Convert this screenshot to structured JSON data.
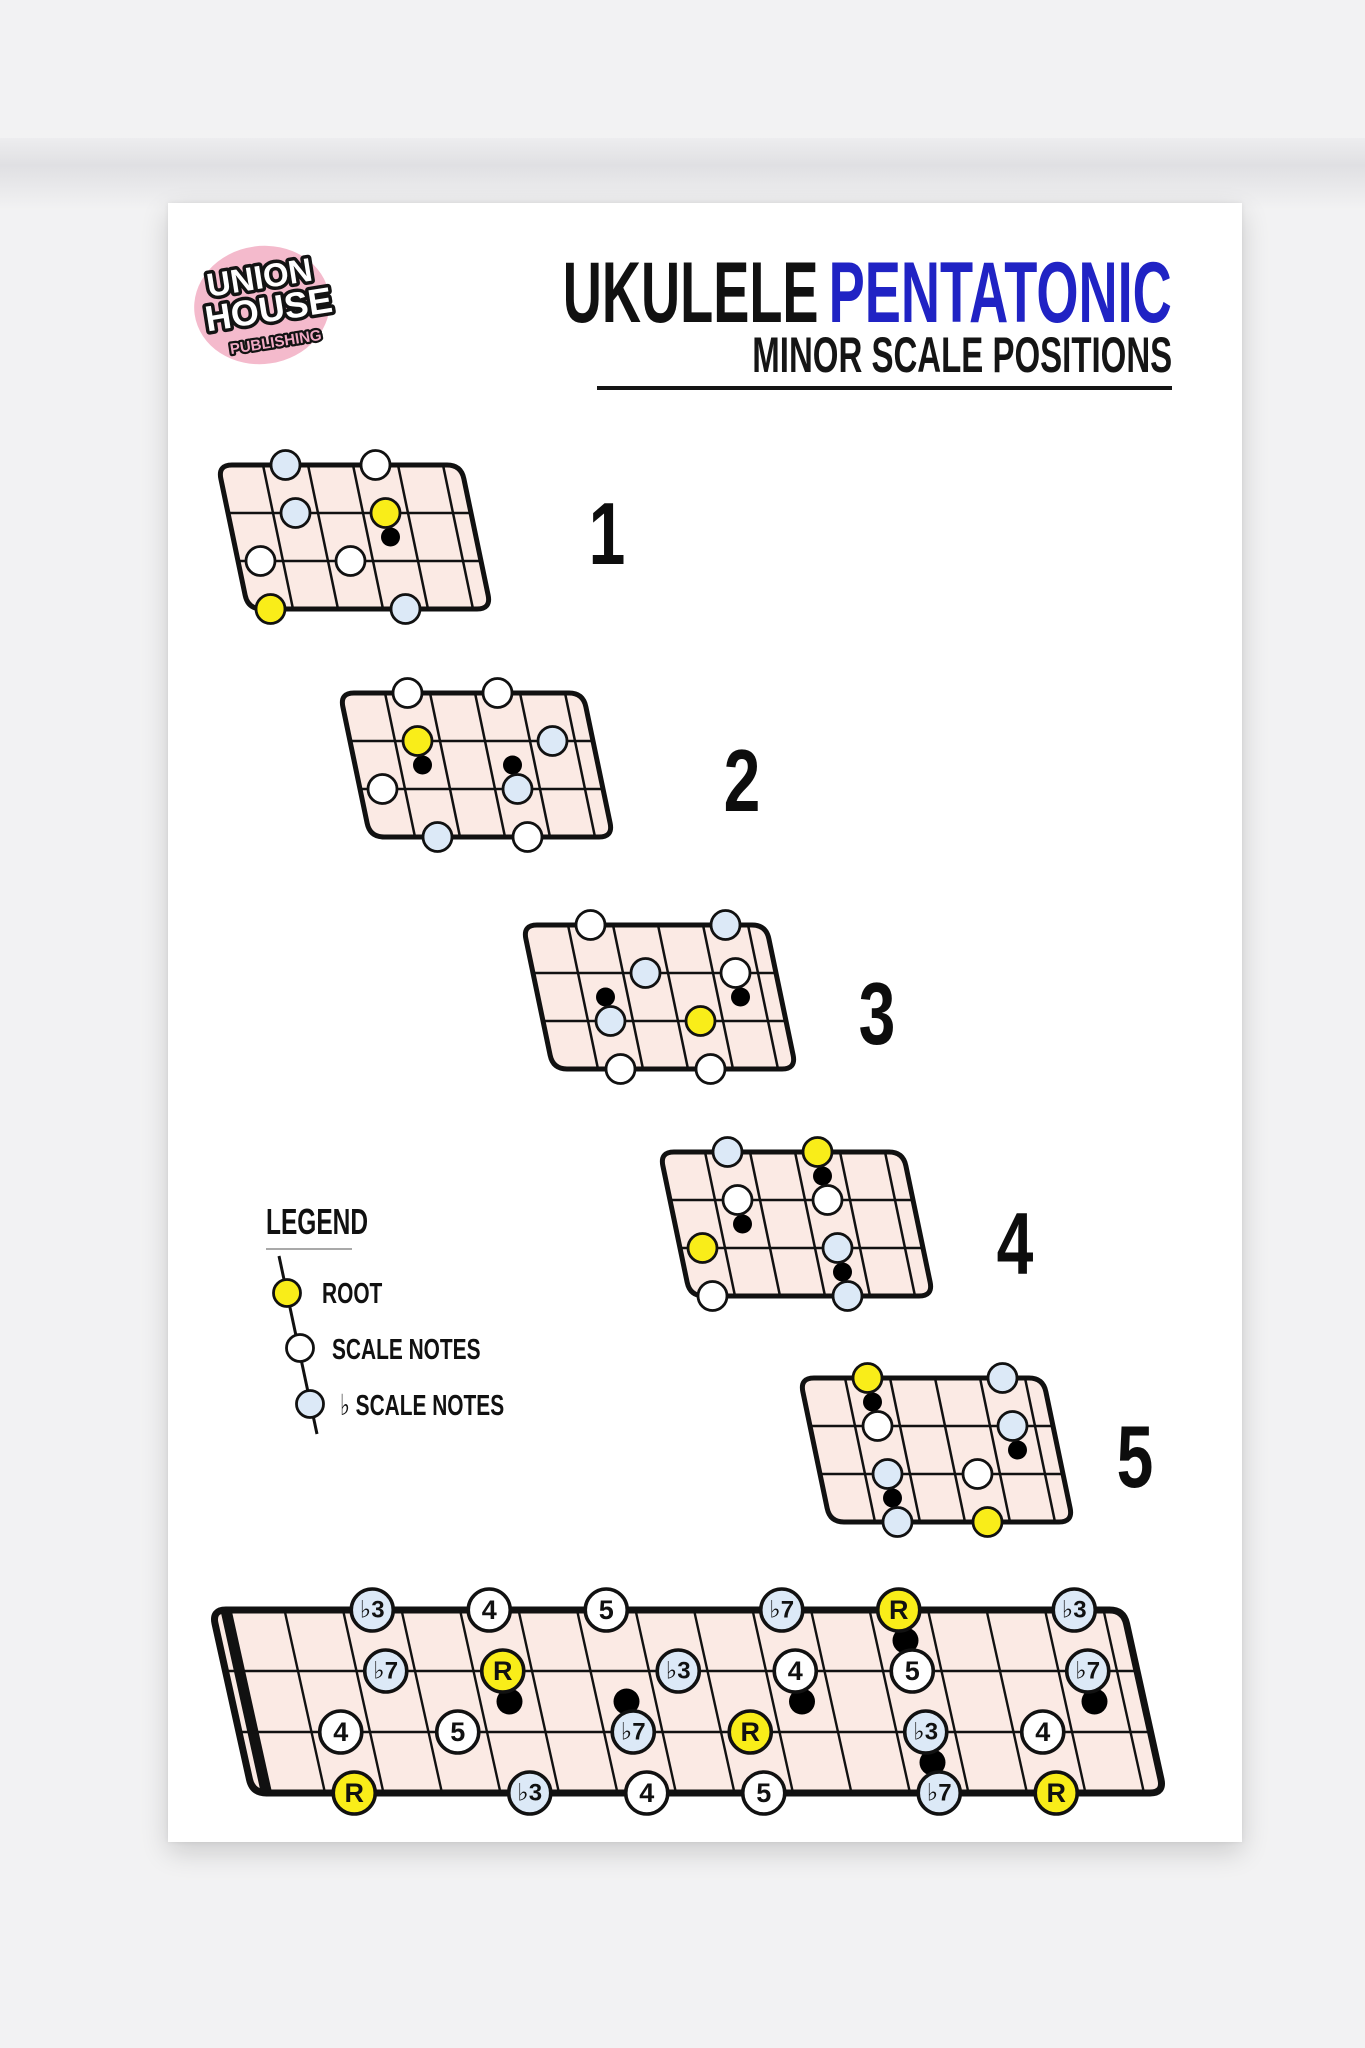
{
  "logo": {
    "line1": "UNION",
    "line2": "HOUSE",
    "line3": "PUBLISHING"
  },
  "title": {
    "black": "UKULELE",
    "blue": "PENTATONIC",
    "subtitle": "MINOR SCALE POSITIONS"
  },
  "legend": {
    "heading": "LEGEND",
    "items": [
      {
        "key": "root",
        "label": "ROOT"
      },
      {
        "key": "scale",
        "label": "SCALE NOTES"
      },
      {
        "key": "flat",
        "label": "♭ SCALE NOTES"
      }
    ]
  },
  "colors": {
    "page_bg": "#f2f2f3",
    "poster_bg": "#ffffff",
    "board_fill": "#fbeae4",
    "line": "#111111",
    "root": "#f9ed19",
    "scale": "#ffffff",
    "flat": "#dce9f7",
    "marker": "#000000",
    "title_blue": "#2023c4",
    "logo_pink": "#f4bacc",
    "logo_text_pink": "#f0a9c3"
  },
  "positions": [
    {
      "number": "1",
      "first_fret": 2,
      "notes": [
        {
          "s": 0,
          "f": 3,
          "t": "flat"
        },
        {
          "s": 0,
          "f": 5,
          "t": "scale"
        },
        {
          "s": 1,
          "f": 3,
          "t": "flat"
        },
        {
          "s": 1,
          "f": 5,
          "t": "root"
        },
        {
          "s": 2,
          "f": 2,
          "t": "scale"
        },
        {
          "s": 2,
          "f": 4,
          "t": "scale"
        },
        {
          "s": 3,
          "f": 2,
          "t": "root"
        },
        {
          "s": 3,
          "f": 5,
          "t": "flat"
        }
      ],
      "markers": [
        {
          "f": 5,
          "b": 1
        }
      ]
    },
    {
      "number": "2",
      "first_fret": 4,
      "notes": [
        {
          "s": 0,
          "f": 5,
          "t": "scale"
        },
        {
          "s": 0,
          "f": 7,
          "t": "scale"
        },
        {
          "s": 1,
          "f": 5,
          "t": "root"
        },
        {
          "s": 1,
          "f": 8,
          "t": "flat"
        },
        {
          "s": 2,
          "f": 4,
          "t": "scale"
        },
        {
          "s": 2,
          "f": 7,
          "t": "flat"
        },
        {
          "s": 3,
          "f": 5,
          "t": "flat"
        },
        {
          "s": 3,
          "f": 7,
          "t": "scale"
        }
      ],
      "markers": [
        {
          "f": 5,
          "b": 1
        },
        {
          "f": 7,
          "b": 1
        }
      ]
    },
    {
      "number": "3",
      "first_fret": 6,
      "notes": [
        {
          "s": 0,
          "f": 7,
          "t": "scale"
        },
        {
          "s": 0,
          "f": 10,
          "t": "flat"
        },
        {
          "s": 1,
          "f": 8,
          "t": "flat"
        },
        {
          "s": 1,
          "f": 10,
          "t": "scale"
        },
        {
          "s": 2,
          "f": 7,
          "t": "flat"
        },
        {
          "s": 2,
          "f": 9,
          "t": "root"
        },
        {
          "s": 3,
          "f": 7,
          "t": "scale"
        },
        {
          "s": 3,
          "f": 9,
          "t": "scale"
        }
      ],
      "markers": [
        {
          "f": 7,
          "b": 1
        },
        {
          "f": 10,
          "b": 1
        }
      ]
    },
    {
      "number": "4",
      "first_fret": 9,
      "notes": [
        {
          "s": 0,
          "f": 10,
          "t": "flat"
        },
        {
          "s": 0,
          "f": 12,
          "t": "root"
        },
        {
          "s": 1,
          "f": 10,
          "t": "scale"
        },
        {
          "s": 1,
          "f": 12,
          "t": "scale"
        },
        {
          "s": 2,
          "f": 9,
          "t": "root"
        },
        {
          "s": 2,
          "f": 12,
          "t": "flat"
        },
        {
          "s": 3,
          "f": 9,
          "t": "scale"
        },
        {
          "s": 3,
          "f": 12,
          "t": "flat"
        }
      ],
      "markers": [
        {
          "f": 10,
          "b": 1
        },
        {
          "f": 12,
          "b": 0
        },
        {
          "f": 12,
          "b": 2
        }
      ]
    },
    {
      "number": "5",
      "first_fret": 11,
      "notes": [
        {
          "s": 0,
          "f": 12,
          "t": "root"
        },
        {
          "s": 0,
          "f": 15,
          "t": "flat"
        },
        {
          "s": 1,
          "f": 12,
          "t": "scale"
        },
        {
          "s": 1,
          "f": 15,
          "t": "flat"
        },
        {
          "s": 2,
          "f": 12,
          "t": "flat"
        },
        {
          "s": 2,
          "f": 14,
          "t": "scale"
        },
        {
          "s": 3,
          "f": 12,
          "t": "flat"
        },
        {
          "s": 3,
          "f": 14,
          "t": "root"
        }
      ],
      "markers": [
        {
          "f": 12,
          "b": 0
        },
        {
          "f": 12,
          "b": 2
        },
        {
          "f": 15,
          "b": 1
        }
      ]
    }
  ],
  "full_neck": {
    "fret_count": 15,
    "notes": [
      {
        "s": 0,
        "f": 3,
        "t": "flat",
        "label": "♭3"
      },
      {
        "s": 0,
        "f": 5,
        "t": "scale",
        "label": "4"
      },
      {
        "s": 0,
        "f": 7,
        "t": "scale",
        "label": "5"
      },
      {
        "s": 0,
        "f": 10,
        "t": "flat",
        "label": "♭7"
      },
      {
        "s": 0,
        "f": 12,
        "t": "root",
        "label": "R"
      },
      {
        "s": 0,
        "f": 15,
        "t": "flat",
        "label": "♭3"
      },
      {
        "s": 1,
        "f": 3,
        "t": "flat",
        "label": "♭7"
      },
      {
        "s": 1,
        "f": 5,
        "t": "root",
        "label": "R"
      },
      {
        "s": 1,
        "f": 8,
        "t": "flat",
        "label": "♭3"
      },
      {
        "s": 1,
        "f": 10,
        "t": "scale",
        "label": "4"
      },
      {
        "s": 1,
        "f": 12,
        "t": "scale",
        "label": "5"
      },
      {
        "s": 1,
        "f": 15,
        "t": "flat",
        "label": "♭7"
      },
      {
        "s": 2,
        "f": 2,
        "t": "scale",
        "label": "4"
      },
      {
        "s": 2,
        "f": 4,
        "t": "scale",
        "label": "5"
      },
      {
        "s": 2,
        "f": 7,
        "t": "flat",
        "label": "♭7"
      },
      {
        "s": 2,
        "f": 9,
        "t": "root",
        "label": "R"
      },
      {
        "s": 2,
        "f": 12,
        "t": "flat",
        "label": "♭3"
      },
      {
        "s": 2,
        "f": 14,
        "t": "scale",
        "label": "4"
      },
      {
        "s": 3,
        "f": 2,
        "t": "root",
        "label": "R"
      },
      {
        "s": 3,
        "f": 5,
        "t": "flat",
        "label": "♭3"
      },
      {
        "s": 3,
        "f": 7,
        "t": "scale",
        "label": "4"
      },
      {
        "s": 3,
        "f": 9,
        "t": "scale",
        "label": "5"
      },
      {
        "s": 3,
        "f": 12,
        "t": "flat",
        "label": "♭7"
      },
      {
        "s": 3,
        "f": 14,
        "t": "root",
        "label": "R"
      }
    ],
    "markers": [
      {
        "f": 5,
        "b": 1
      },
      {
        "f": 7,
        "b": 1
      },
      {
        "f": 10,
        "b": 1
      },
      {
        "f": 12,
        "b": 0
      },
      {
        "f": 12,
        "b": 2
      },
      {
        "f": 15,
        "b": 1
      }
    ]
  }
}
